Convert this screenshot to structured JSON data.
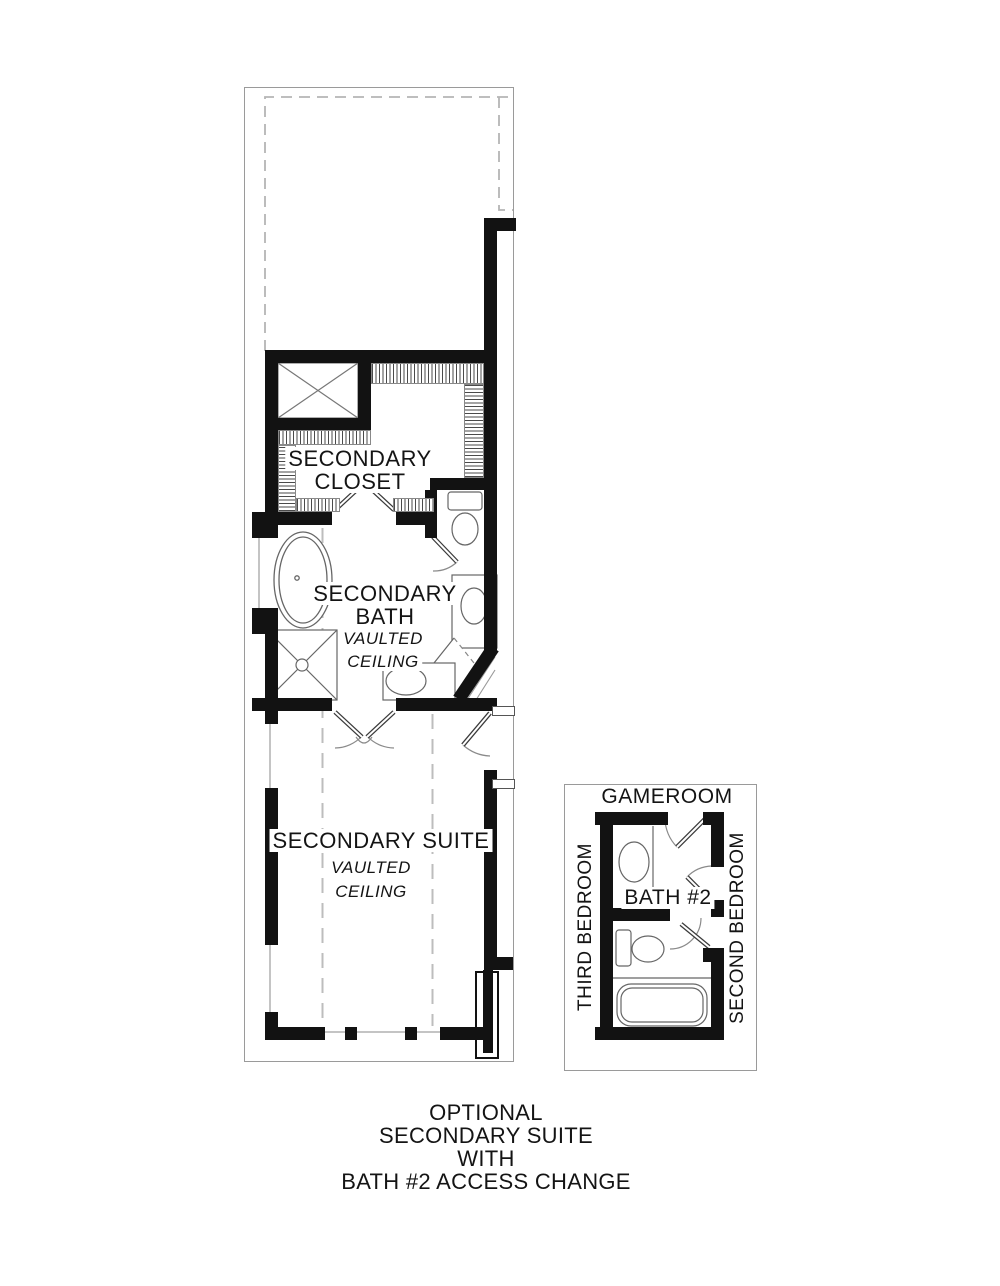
{
  "rooms": {
    "secondary_closet": {
      "line1": "SECONDARY",
      "line2": "CLOSET"
    },
    "secondary_bath": {
      "line1": "SECONDARY",
      "line2": "BATH",
      "note_line1": "VAULTED",
      "note_line2": "CEILING"
    },
    "secondary_suite": {
      "line1": "SECONDARY SUITE",
      "note_line1": "VAULTED",
      "note_line2": "CEILING"
    },
    "gameroom": {
      "label": "GAMEROOM"
    },
    "bath_2": {
      "label": "BATH #2"
    },
    "third_bedroom": {
      "label": "THIRD BEDROOM"
    },
    "second_bedroom": {
      "label": "SECOND BEDROOM"
    }
  },
  "caption": {
    "line1": "OPTIONAL",
    "line2": "SECONDARY SUITE",
    "line3": "WITH",
    "line4": "BATH #2 ACCESS CHANGE"
  },
  "colors": {
    "wall": "#121212",
    "thin_line": "#666666",
    "dashed_line": "#b5b5b5",
    "page_border": "#9a9a9a",
    "text": "#141414",
    "background": "#ffffff"
  }
}
